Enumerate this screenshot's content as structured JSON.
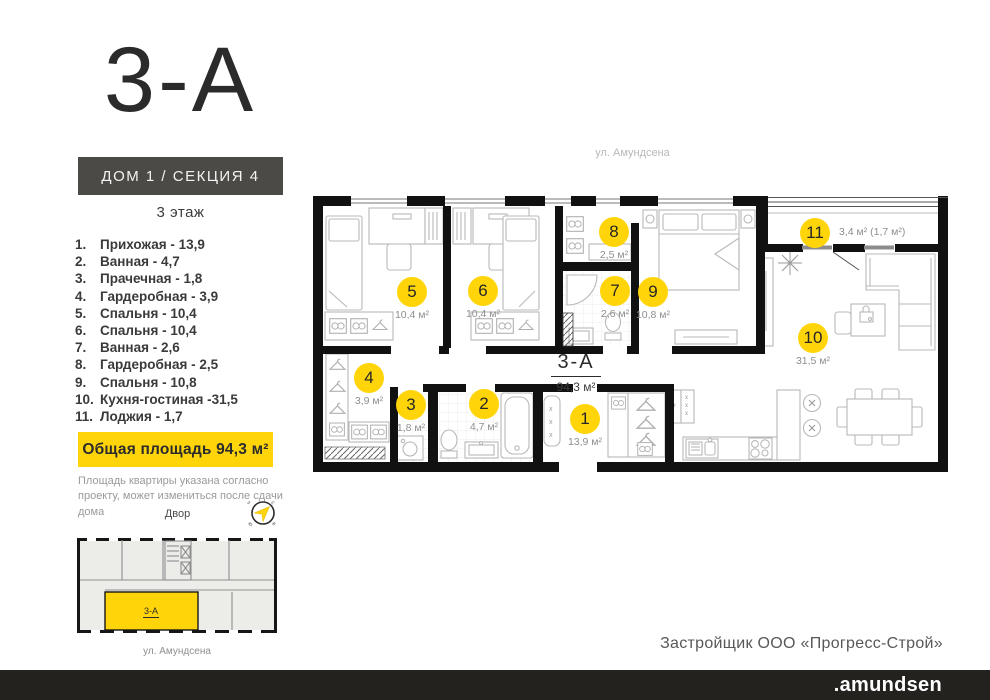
{
  "colors": {
    "accent": "#ffd50a",
    "wall": "#111111",
    "dark_box": "#4b4a47",
    "footer_bg": "#23221f"
  },
  "header": {
    "unit_title": "3-А",
    "building_label": "ДОМ 1 / СЕКЦИЯ 4",
    "floor_label": "3 этаж"
  },
  "room_list": [
    {
      "num": "1.",
      "label": "Прихожая - 13,9"
    },
    {
      "num": "2.",
      "label": "Ванная - 4,7"
    },
    {
      "num": "3.",
      "label": "Прачечная - 1,8"
    },
    {
      "num": "4.",
      "label": "Гардеробная - 3,9"
    },
    {
      "num": "5.",
      "label": "Спальня - 10,4"
    },
    {
      "num": "6.",
      "label": "Спальня - 10,4"
    },
    {
      "num": "7.",
      "label": "Ванная - 2,6"
    },
    {
      "num": "8.",
      "label": "Гардеробная - 2,5"
    },
    {
      "num": "9.",
      "label": "Спальня - 10,8"
    },
    {
      "num": "10.",
      "label": "Кухня-гостиная -31,5"
    },
    {
      "num": "11.",
      "label": "Лоджия - 1,7"
    }
  ],
  "total_area_label": "Общая площадь 94,3 м²",
  "disclaimer": "Площадь квартиры указана согласно проекту, может измениться после сдачи дома",
  "courtyard_label": "Двор",
  "compass_letters": {
    "ne": "с",
    "se": "в",
    "sw": "ю",
    "nw": "з"
  },
  "mini_plan": {
    "unit_label": "3-А",
    "street_label": "ул. Амундсена"
  },
  "plan": {
    "street_label": "ул. Амундсена",
    "unit_label": "3-А",
    "unit_area": "94,3 м²",
    "badges": [
      {
        "num": "1",
        "area": "13,9 м²",
        "x": 585,
        "y": 419
      },
      {
        "num": "2",
        "area": "4,7 м²",
        "x": 484,
        "y": 404
      },
      {
        "num": "3",
        "area": "1,8 м²",
        "x": 411,
        "y": 405
      },
      {
        "num": "4",
        "area": "3,9 м²",
        "x": 369,
        "y": 378
      },
      {
        "num": "5",
        "area": "10,4 м²",
        "x": 412,
        "y": 292
      },
      {
        "num": "6",
        "area": "10,4 м²",
        "x": 483,
        "y": 291
      },
      {
        "num": "7",
        "area": "2,6 м²",
        "x": 615,
        "y": 291
      },
      {
        "num": "8",
        "area": "2,5 м²",
        "x": 614,
        "y": 232
      },
      {
        "num": "9",
        "area": "10,8 м²",
        "x": 653,
        "y": 292
      },
      {
        "num": "10",
        "area": "31,5 м²",
        "x": 813,
        "y": 338
      },
      {
        "num": "11",
        "area": "3,4 м² (1,7 м²)",
        "x": 815,
        "y": 233,
        "side": "right"
      }
    ]
  },
  "footer": {
    "developer": "Застройщик ООО «Прогресс-Строй»",
    "brand": ".amundsen"
  }
}
